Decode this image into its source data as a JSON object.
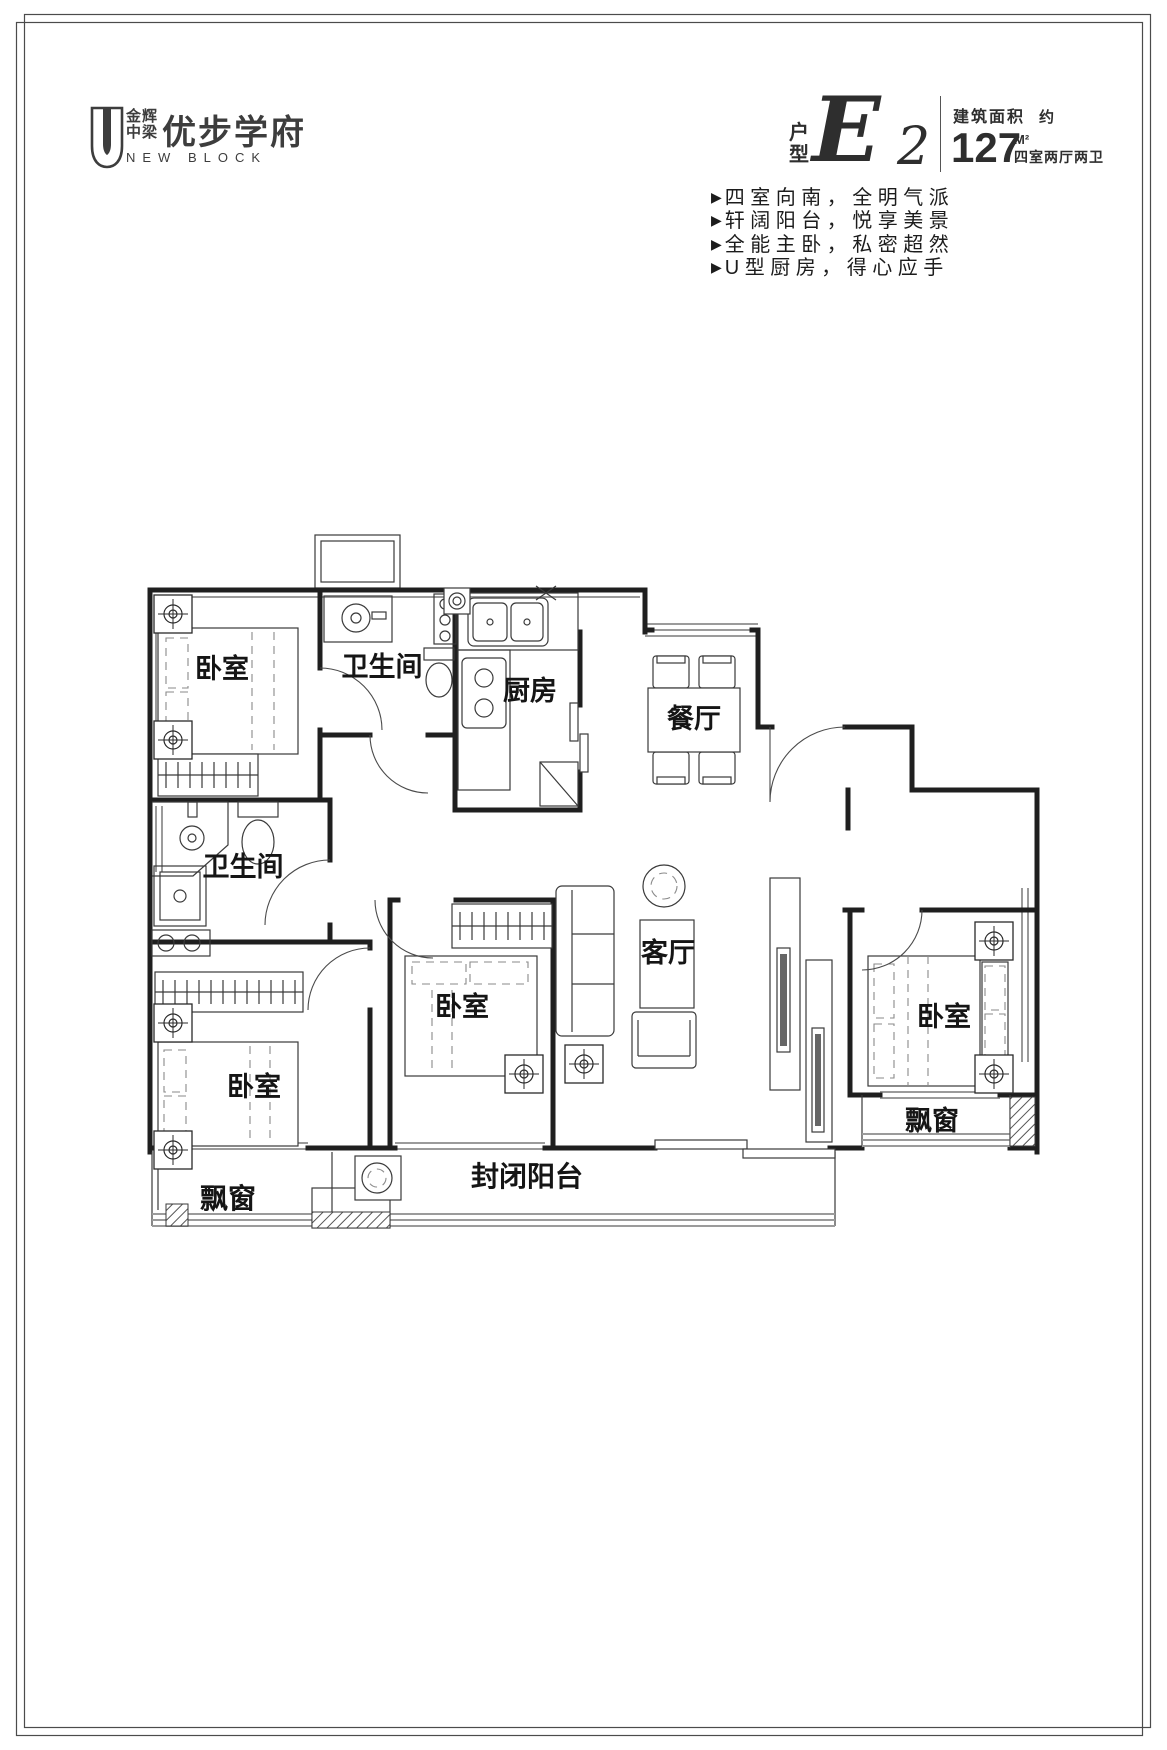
{
  "page": {
    "bg": "#ffffff",
    "frame_color": "#4b4b4b",
    "wall_color": "#1f1f1f"
  },
  "header": {
    "logo": {
      "icon": "u-shield-icon",
      "brand_top": "金辉",
      "brand_bottom": "中梁",
      "name": "优步学府",
      "subtitle": "NEW BLOCK"
    },
    "unit": {
      "label_top": "户",
      "label_bottom": "型",
      "letter": "E",
      "number": "2",
      "area_label": "建筑面积",
      "area_approx": "约",
      "area_value": "127",
      "area_unit": "M²",
      "rooms_desc": "四室两厅两卫"
    },
    "marker": "▶",
    "features": [
      "四室向南，全明气派",
      "轩阔阳台，悦享美景",
      "全能主卧，私密超然",
      "U型厨房，得心应手"
    ]
  },
  "floorplan": {
    "rooms": {
      "bedroom_top_left": "卧室",
      "bath_top": "卫生间",
      "kitchen": "厨房",
      "dining": "餐厅",
      "bath_left": "卫生间",
      "bedroom_center": "卧室",
      "living": "客厅",
      "bedroom_right": "卧室",
      "bedroom_bottom_left": "卧室",
      "bay_window_left": "飘窗",
      "balcony": "封闭阳台",
      "bay_window_right": "飘窗"
    }
  }
}
